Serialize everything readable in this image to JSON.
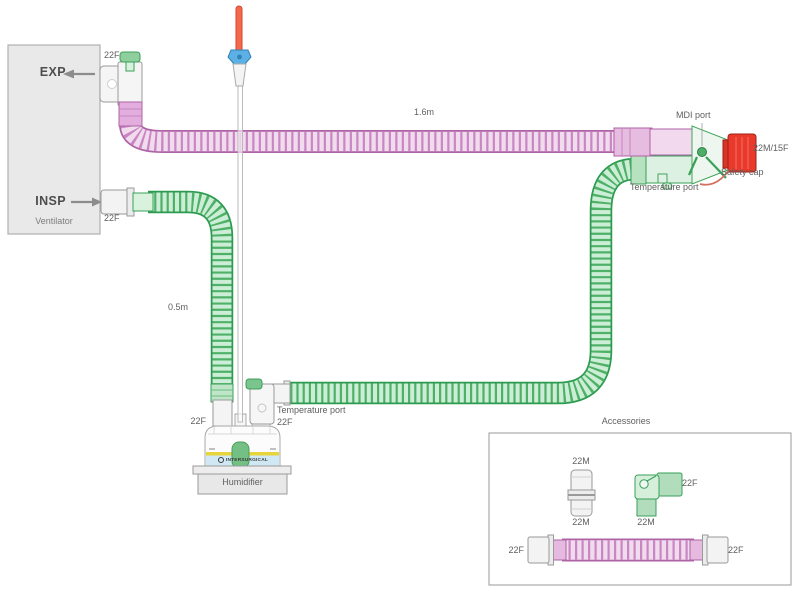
{
  "ventilator": {
    "exp": "EXP",
    "insp": "INSP",
    "label": "Ventilator",
    "exp_port": "22F",
    "insp_port": "22F"
  },
  "circuit": {
    "exp_limb_length": "1.6m",
    "insp_limb_length": "0.5m",
    "mdi_port": "MDI port",
    "patient_connector": "22M/15F",
    "safety_cap": "Safety cap",
    "wye_temp_port": "Temperature port",
    "outlet_temp_port": "Temperature port",
    "outlet_size": "22F",
    "inlet_size": "22F"
  },
  "humidifier": {
    "label": "Humidifier",
    "brand": "INTERSURGICAL"
  },
  "accessories": {
    "title": "Accessories",
    "adapter": {
      "top": "22M",
      "bottom": "22M"
    },
    "elbow": {
      "male": "22M",
      "female": "22F"
    },
    "catheter": {
      "left": "22F",
      "right": "22F"
    }
  },
  "icons": {
    "exp_flow_arrow": "arrow-left",
    "insp_flow_arrow": "arrow-right",
    "temperature_probe": "probe"
  },
  "colors": {
    "exp_limb_pink": "#ca86c4",
    "insp_limb_green": "#2c9b50",
    "safety_cap_red": "#e8392b",
    "probe_blue": "#5db0e4",
    "water_blue": "#cfe8f4",
    "ventilator_gray": "#e9e9e9"
  }
}
